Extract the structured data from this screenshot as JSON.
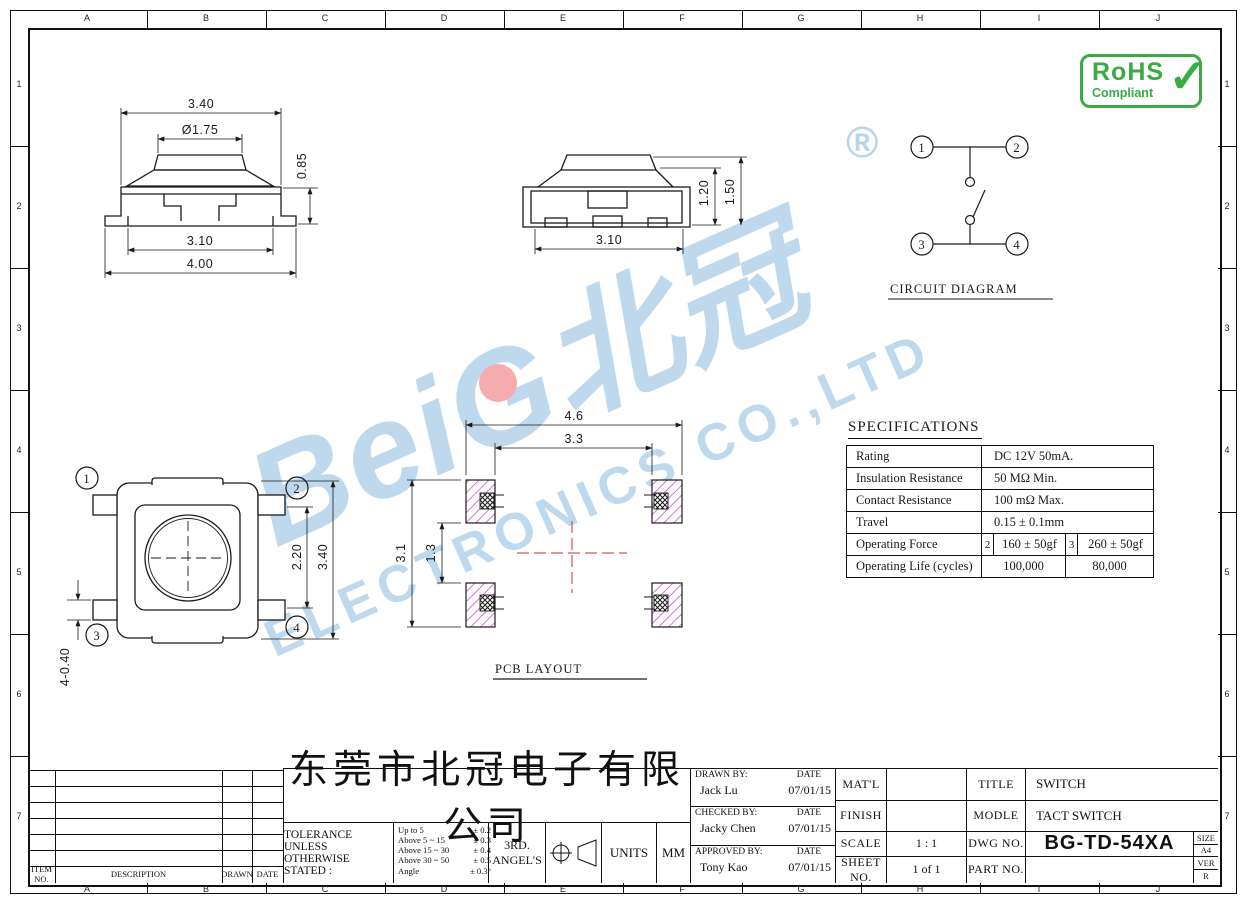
{
  "frame": {
    "letters": [
      "A",
      "B",
      "C",
      "D",
      "E",
      "F",
      "G",
      "H",
      "I",
      "J"
    ],
    "numbers": [
      "1",
      "2",
      "3",
      "4",
      "5",
      "6",
      "7"
    ]
  },
  "watermark": {
    "brand": "BeiG北冠",
    "subtitle": "ELECTRONICS CO.,LTD",
    "registered": "®",
    "color": "#b7d5ec"
  },
  "rohs": {
    "title": "RoHS",
    "subtitle": "Compliant",
    "check": "✓",
    "color": "#3aaa44"
  },
  "front_view": {
    "dim_width_top": "3.40",
    "dim_button": "Ø1.75",
    "dim_height": "0.85",
    "dim_width_inner": "3.10",
    "dim_width_outer": "4.00"
  },
  "side_view": {
    "dim_width": "3.10",
    "dim_h1": "1.20",
    "dim_h2": "1.50"
  },
  "top_view": {
    "pin1": "1",
    "pin2": "2",
    "pin3": "3",
    "pin4": "4",
    "dim_inner": "2.20",
    "dim_outer": "3.40",
    "dim_lead": "4-0.40"
  },
  "circuit": {
    "title": "CIRCUIT DIAGRAM",
    "pin1": "1",
    "pin2": "2",
    "pin3": "3",
    "pin4": "4"
  },
  "pcb": {
    "title": "PCB LAYOUT",
    "dim_outer_w": "4.6",
    "dim_inner_w": "3.3",
    "dim_outer_h": "3.1",
    "dim_inner_h": "1.3"
  },
  "specs": {
    "title": "SPECIFICATIONS",
    "rows": [
      {
        "label": "Rating",
        "value": "DC 12V 50mA."
      },
      {
        "label": "Insulation Resistance",
        "value": "50 MΩ Min."
      },
      {
        "label": "Contact Resistance",
        "value": "100 mΩ Max."
      },
      {
        "label": "Travel",
        "value": "0.15 ± 0.1mm"
      }
    ],
    "force": {
      "label": "Operating Force",
      "k1": "2",
      "v1": "160 ± 50gf",
      "k2": "3",
      "v2": "260 ± 50gf"
    },
    "life": {
      "label": "Operating Life (cycles)",
      "v1": "100,000",
      "v2": "80,000"
    }
  },
  "titleblock": {
    "company": "东莞市北冠电子有限公司",
    "tolerance_line1": "TOLERANCE UNLESS",
    "tolerance_line2": "OTHERWISE STATED :",
    "tolerances": [
      {
        "range": "Up to 5",
        "value": "± 0.2"
      },
      {
        "range": "Above 5  ~ 15",
        "value": "± 0.3"
      },
      {
        "range": "Above 15 ~ 30",
        "value": "± 0.4"
      },
      {
        "range": "Above 30 ~ 50",
        "value": "± 0.5"
      },
      {
        "range": "Angle",
        "value": "± 0.3°"
      }
    ],
    "angle_line1": "3RD.",
    "angle_line2": "ANGEL'S",
    "units_label": "UNITS",
    "units_value": "MM",
    "date_label": "DATE",
    "drawn_label": "DRAWN BY:",
    "drawn_name": "Jack  Lu",
    "drawn_date": "07/01/15",
    "checked_label": "CHECKED BY:",
    "checked_name": "Jacky Chen",
    "checked_date": "07/01/15",
    "approved_label": "APPROVED BY:",
    "approved_name": "Tony Kao",
    "approved_date": "07/01/15",
    "matl_label": "MAT'L",
    "matl_value": "",
    "finish_label": "FINISH",
    "finish_value": "",
    "scale_label": "SCALE",
    "scale_value": "1 : 1",
    "sheet_label": "SHEET NO.",
    "sheet_value": "1 of 1",
    "title_label": "TITLE",
    "title_value": "SWITCH",
    "modle_label": "MODLE",
    "modle_value": "TACT SWITCH",
    "dwg_label": "DWG NO.",
    "dwg_value": "BG-TD-54XA",
    "part_label": "PART NO.",
    "part_value": "",
    "size_label": "SIZE",
    "size_value": "A4",
    "ver_label": "VER",
    "ver_value": "R"
  },
  "revision": {
    "item": "ITEM NO.",
    "description": "DESCRIPTION",
    "drawn": "DRAWN",
    "date": "DATE"
  }
}
